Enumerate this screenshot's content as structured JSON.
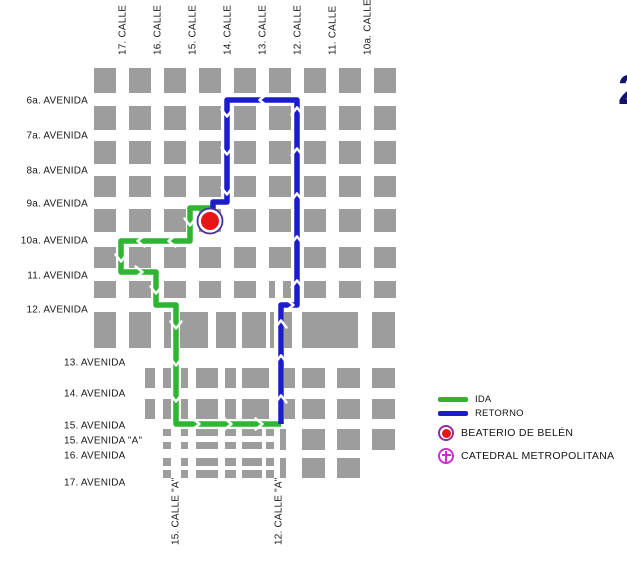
{
  "map": {
    "width": 627,
    "height": 565,
    "colors": {
      "block": "#9d9d9d",
      "ida": "#2eb532",
      "retorno": "#1c1ccd",
      "label": "#1a1a1a",
      "marker_red": "#e81417",
      "marker_ring": "#4b2da0",
      "legend_ring": "#8e2da0",
      "catedral": "#cc2fcc",
      "corner_number": "#14146e",
      "arrow": "#ffffff"
    },
    "streets_top": [
      {
        "label": "17. CALLE",
        "x": 122
      },
      {
        "label": "16. CALLE",
        "x": 157
      },
      {
        "label": "15. CALLE",
        "x": 192
      },
      {
        "label": "14. CALLE",
        "x": 227
      },
      {
        "label": "13. CALLE",
        "x": 262
      },
      {
        "label": "12. CALLE",
        "x": 297
      },
      {
        "label": "11. CALLE",
        "x": 332
      },
      {
        "label": "10a. CALLE",
        "x": 367
      }
    ],
    "avenues_upper": [
      {
        "label": "6a. AVENIDA",
        "y": 100
      },
      {
        "label": "7a. AVENIDA",
        "y": 135
      },
      {
        "label": "8a. AVENIDA",
        "y": 170
      },
      {
        "label": "9a. AVENIDA",
        "y": 203
      },
      {
        "label": "10a. AVENIDA",
        "y": 240
      },
      {
        "label": "11. AVENIDA",
        "y": 275
      },
      {
        "label": "12. AVENIDA",
        "y": 309
      }
    ],
    "avenues_lower": [
      {
        "label": "13. AVENIDA",
        "y": 362
      },
      {
        "label": "14. AVENIDA",
        "y": 393
      },
      {
        "label": "15. AVENIDA",
        "y": 425
      },
      {
        "label": "15. AVENIDA \"A\"",
        "y": 440
      },
      {
        "label": "16. AVENIDA",
        "y": 455
      },
      {
        "label": "17. AVENIDA",
        "y": 482
      }
    ],
    "streets_bottom": [
      {
        "label": "15. CALLE \"A\"",
        "x": 175
      },
      {
        "label": "12. CALLE \"A\"",
        "x": 278
      }
    ],
    "corner_number": "2",
    "grid": {
      "col_xs": [
        94,
        129,
        164,
        199,
        234,
        269,
        304,
        339,
        374
      ],
      "col_w": 22,
      "upper_rows": [
        {
          "y": 68,
          "h": 25
        },
        {
          "y": 106,
          "h": 24
        },
        {
          "y": 141,
          "h": 23
        },
        {
          "y": 176,
          "h": 21
        },
        {
          "y": 209,
          "h": 23
        },
        {
          "y": 247,
          "h": 21
        },
        {
          "y": 281,
          "h": 17,
          "splits": {
            "269": [
              [
                269,
                6
              ],
              [
                283,
                8
              ]
            ]
          }
        },
        {
          "y": 312,
          "h": 36,
          "blocks": [
            [
              94,
              22
            ],
            [
              129,
              22
            ],
            [
              164,
              7
            ],
            [
              180,
              28
            ],
            [
              216,
              20
            ],
            [
              242,
              24
            ],
            [
              270,
              4
            ],
            [
              284,
              8
            ],
            [
              302,
              56
            ],
            [
              372,
              23
            ]
          ]
        }
      ],
      "lower_rows": [
        {
          "y": 368,
          "h": 20,
          "blocks": [
            [
              145,
              10
            ],
            [
              163,
              8
            ],
            [
              181,
              7
            ],
            [
              196,
              22
            ],
            [
              225,
              11
            ],
            [
              242,
              27
            ],
            [
              284,
              11
            ],
            [
              302,
              23
            ],
            [
              337,
              23
            ],
            [
              372,
              23
            ]
          ]
        },
        {
          "y": 399,
          "h": 20,
          "blocks": [
            [
              145,
              10
            ],
            [
              163,
              8
            ],
            [
              181,
              7
            ],
            [
              196,
              22
            ],
            [
              225,
              11
            ],
            [
              242,
              27
            ],
            [
              284,
              11
            ],
            [
              302,
              23
            ],
            [
              337,
              23
            ],
            [
              372,
              23
            ]
          ]
        },
        {
          "y": 429,
          "h": 7,
          "blocks": [
            [
              163,
              8
            ],
            [
              181,
              7
            ],
            [
              196,
              22
            ],
            [
              225,
              11
            ],
            [
              242,
              20
            ],
            [
              266,
              8
            ]
          ]
        },
        {
          "y": 442,
          "h": 7,
          "blocks": [
            [
              163,
              8
            ],
            [
              181,
              7
            ],
            [
              196,
              22
            ],
            [
              225,
              11
            ],
            [
              242,
              20
            ],
            [
              266,
              8
            ]
          ]
        },
        {
          "y": 429,
          "h": 21,
          "blocks": [
            [
              280,
              6
            ],
            [
              302,
              23
            ],
            [
              337,
              23
            ],
            [
              372,
              23
            ]
          ]
        },
        {
          "y": 458,
          "h": 8,
          "blocks": [
            [
              163,
              8
            ],
            [
              181,
              7
            ],
            [
              196,
              22
            ],
            [
              225,
              11
            ],
            [
              242,
              20
            ],
            [
              266,
              8
            ]
          ]
        },
        {
          "y": 470,
          "h": 8,
          "blocks": [
            [
              163,
              8
            ],
            [
              181,
              7
            ],
            [
              196,
              22
            ],
            [
              225,
              11
            ],
            [
              242,
              20
            ],
            [
              266,
              8
            ]
          ]
        },
        {
          "y": 458,
          "h": 20,
          "blocks": [
            [
              280,
              6
            ],
            [
              302,
              23
            ],
            [
              337,
              23
            ]
          ]
        }
      ]
    },
    "route_ida": {
      "name": "IDA",
      "points": [
        [
          212,
          208
        ],
        [
          190,
          208
        ],
        [
          190,
          241
        ],
        [
          121,
          241
        ],
        [
          121,
          272
        ],
        [
          156,
          272
        ],
        [
          156,
          305
        ],
        [
          176,
          305
        ],
        [
          176,
          424
        ],
        [
          281,
          424
        ]
      ],
      "arrows": [
        [
          190,
          222,
          "down"
        ],
        [
          172,
          241,
          "left"
        ],
        [
          141,
          241,
          "left"
        ],
        [
          121,
          258,
          "down"
        ],
        [
          139,
          272,
          "right"
        ],
        [
          156,
          290,
          "down"
        ],
        [
          176,
          325,
          "down"
        ],
        [
          176,
          362,
          "down"
        ],
        [
          176,
          398,
          "down"
        ],
        [
          196,
          424,
          "right"
        ],
        [
          228,
          424,
          "right"
        ],
        [
          259,
          424,
          "right"
        ]
      ]
    },
    "route_retorno": {
      "name": "RETORNO",
      "points": [
        [
          281,
          424
        ],
        [
          281,
          305
        ],
        [
          297,
          305
        ],
        [
          297,
          100
        ],
        [
          227,
          100
        ],
        [
          227,
          202
        ],
        [
          213,
          202
        ],
        [
          213,
          209
        ]
      ],
      "arrows": [
        [
          281,
          399,
          "up"
        ],
        [
          281,
          359,
          "up"
        ],
        [
          281,
          324,
          "up"
        ],
        [
          290,
          305,
          "right"
        ],
        [
          297,
          284,
          "up"
        ],
        [
          297,
          240,
          "up"
        ],
        [
          297,
          197,
          "up"
        ],
        [
          297,
          152,
          "up"
        ],
        [
          297,
          111,
          "up"
        ],
        [
          263,
          100,
          "left"
        ],
        [
          227,
          113,
          "down"
        ],
        [
          227,
          151,
          "down"
        ],
        [
          227,
          191,
          "down"
        ]
      ]
    },
    "beaterio_marker": {
      "cx": 210,
      "cy": 221,
      "r_outer": 12.5,
      "r_inner": 9
    }
  },
  "legend": {
    "ida": "IDA",
    "retorno": "RETORNO",
    "beaterio": "BEATERIO DE BELÉN",
    "catedral": "CATEDRAL METROPOLITANA"
  }
}
